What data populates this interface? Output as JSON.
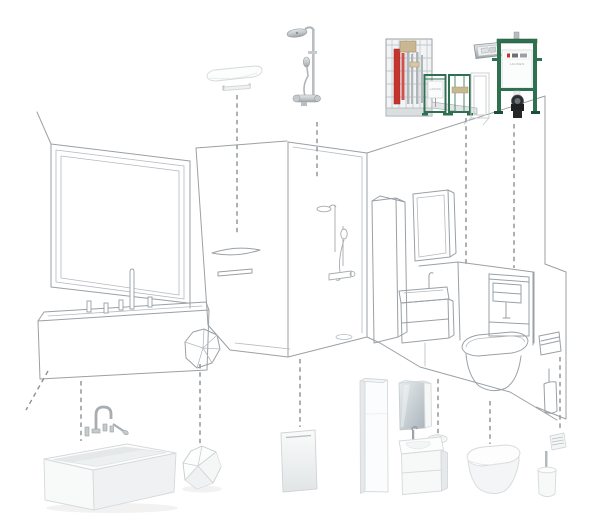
{
  "scene": {
    "type": "exploded-bathroom-product-diagram",
    "brand_label": "LAUFEN",
    "background": "#ffffff",
    "line_color": "#9aa0a5",
    "dash_color": "#8c9094"
  },
  "colors": {
    "frame_green": "#2e7050",
    "frame_green_dark": "#1d4f38",
    "pipe_red": "#c4342f",
    "metal_grey": "#b6bcc0",
    "chrome": "#c9ccce",
    "wood_tan": "#c9b793",
    "product_white": "#fbfcfd",
    "mirror_glass": "#aeb9bf",
    "waste_pipe_black": "#1d1f21"
  },
  "products": [
    {
      "id": "wall-shelf",
      "name": "wall shelf with towel rail"
    },
    {
      "id": "shower-column",
      "name": "thermostatic shower column"
    },
    {
      "id": "installation-system",
      "name": "prewall installation frame system"
    },
    {
      "id": "flush-plate",
      "name": "chrome flush actuator plate"
    },
    {
      "id": "wc-frame",
      "name": "WC installation frame with concealed cistern",
      "brand": "LAUFEN"
    },
    {
      "id": "bath-mixer",
      "name": "deck-mounted bath mixer set"
    },
    {
      "id": "bathtub",
      "name": "freestanding rectangular bathtub"
    },
    {
      "id": "stool",
      "name": "faceted bathroom stool"
    },
    {
      "id": "shower-tray",
      "name": "shower tray"
    },
    {
      "id": "tall-cabinet",
      "name": "tall side cabinet"
    },
    {
      "id": "mirror-cabinet",
      "name": "mirror cabinet"
    },
    {
      "id": "vanity",
      "name": "vanity unit with washbasin and bowl"
    },
    {
      "id": "toilet",
      "name": "wall-hung toilet"
    },
    {
      "id": "roll-holder",
      "name": "toilet roll holder"
    },
    {
      "id": "toilet-brush",
      "name": "toilet brush set"
    }
  ],
  "connectors": [
    {
      "x1": 237,
      "y1": 95,
      "x2": 237,
      "y2": 236
    },
    {
      "x1": 317,
      "y1": 122,
      "x2": 317,
      "y2": 178
    },
    {
      "x1": 466,
      "y1": 118,
      "x2": 466,
      "y2": 265
    },
    {
      "x1": 514,
      "y1": 124,
      "x2": 514,
      "y2": 268
    },
    {
      "x1": 48,
      "y1": 371,
      "x2": 26,
      "y2": 410
    },
    {
      "x1": 81,
      "y1": 381,
      "x2": 81,
      "y2": 441
    },
    {
      "x1": 200,
      "y1": 364,
      "x2": 200,
      "y2": 444
    },
    {
      "x1": 300,
      "y1": 359,
      "x2": 300,
      "y2": 427
    },
    {
      "x1": 438,
      "y1": 379,
      "x2": 438,
      "y2": 438
    },
    {
      "x1": 490,
      "y1": 401,
      "x2": 490,
      "y2": 444
    },
    {
      "x1": 560,
      "y1": 357,
      "x2": 560,
      "y2": 428
    }
  ]
}
